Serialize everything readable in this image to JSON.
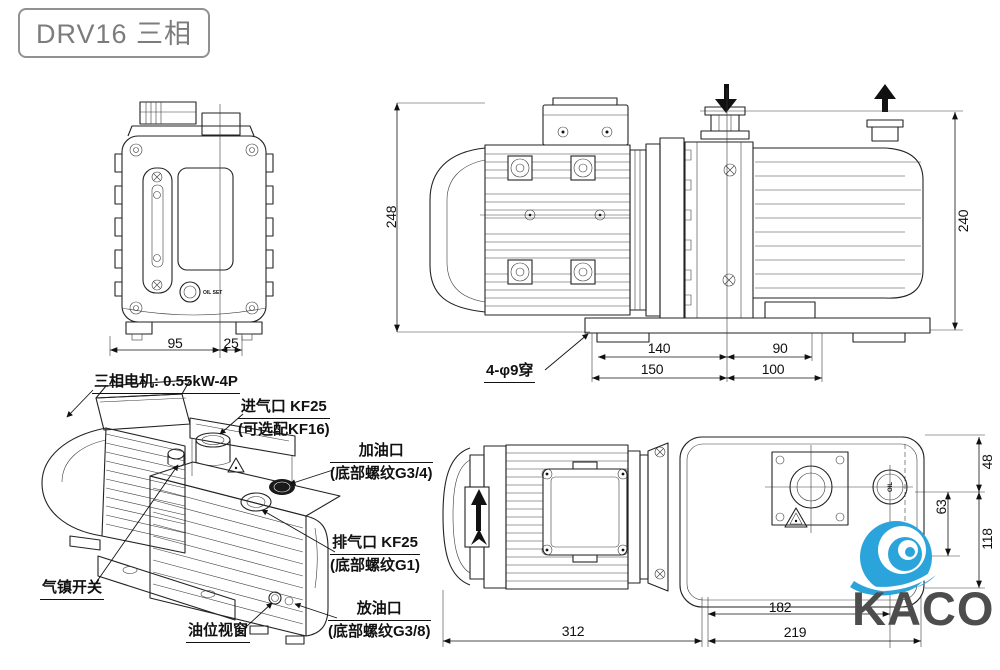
{
  "title": "DRV16 三相",
  "front_view": {
    "dim_95": "95",
    "dim_25": "25",
    "oil_text": "OIL SET"
  },
  "side_view": {
    "dim_height_left": "248",
    "dim_height_right": "240",
    "dim_140": "140",
    "dim_90": "90",
    "dim_150": "150",
    "dim_100": "100",
    "holes_label": "4-φ9穿"
  },
  "iso_view": {
    "motor_label": "三相电机: 0.55kW-4P",
    "inlet_label_1": "进气口 KF25",
    "inlet_label_2": "(可选配KF16)",
    "oil_fill_1": "加油口",
    "oil_fill_2": "(底部螺纹G3/4)",
    "exhaust_1": "排气口 KF25",
    "exhaust_2": "(底部螺纹G1)",
    "drain_1": "放油口",
    "drain_2": "(底部螺纹G3/8)",
    "gas_ballast": "气镇开关",
    "sight_glass": "油位视窗"
  },
  "top_view": {
    "dim_48": "48",
    "dim_63": "63",
    "dim_118": "118",
    "dim_182": "182",
    "dim_219": "219",
    "dim_312": "312",
    "oil_text": "OIL"
  },
  "logo": {
    "text": "KACO",
    "accent": "#2ba4db",
    "text_color": "#4d4d4d"
  }
}
